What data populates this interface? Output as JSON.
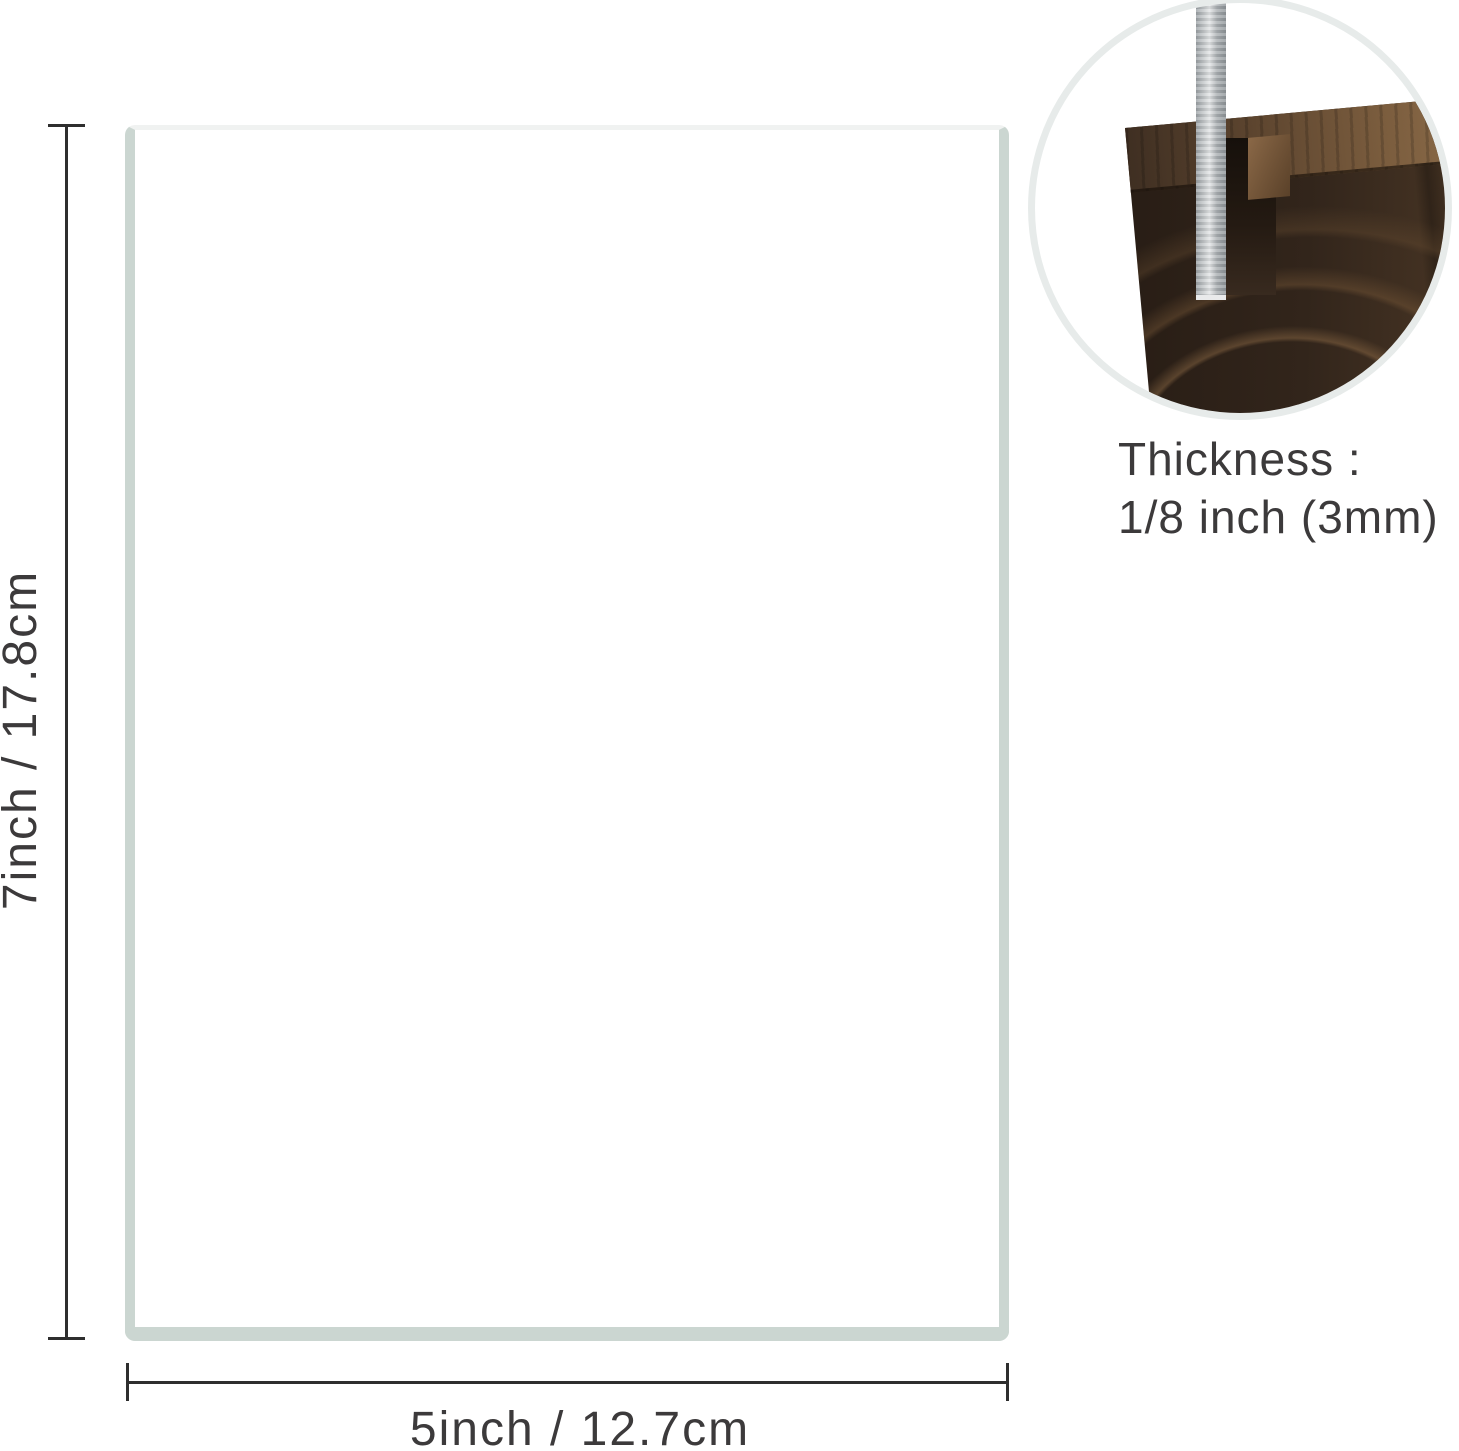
{
  "sheet": {
    "height_label": "7inch / 17.8cm",
    "width_label": "5inch / 12.7cm"
  },
  "inset": {
    "caption_line1": "Thickness :",
    "caption_line2": "1/8 inch (3mm)"
  },
  "colors": {
    "dimension_line": "#2e2e2e",
    "label_text": "#3c3a3b",
    "sheet_border_side": "#cbd6d1",
    "sheet_border_top": "#f0f2f1",
    "circle_ring": "#e7ebea",
    "wood_dark": "#281d15",
    "wood_light": "#8f6f4c",
    "acrylic": "#c2c6c8"
  }
}
